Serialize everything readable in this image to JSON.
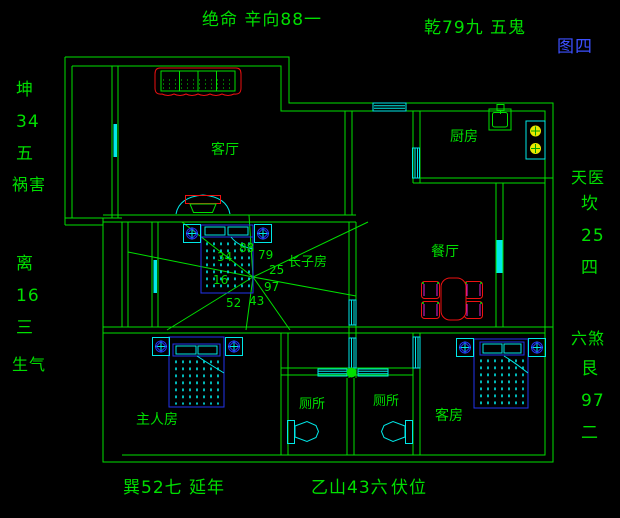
{
  "figure_label": "图四",
  "perimeter": {
    "top": [
      "绝命 辛向88一",
      "乾79九 五鬼"
    ],
    "left": [
      "坤",
      "34",
      "五",
      "祸害",
      "离",
      "16",
      "三",
      "生气"
    ],
    "right": [
      "天医",
      "坎",
      "25",
      "四",
      "六煞",
      "艮",
      "97",
      "二"
    ],
    "bottom": [
      "巽52七",
      "延年",
      "乙山43六",
      "伏位"
    ]
  },
  "rooms": {
    "living_room": "客厅",
    "kitchen": "厨房",
    "dining_room": "餐厅",
    "eldest_son_room": "长子房",
    "master_bedroom": "主人房",
    "toilet_left": "厕所",
    "toilet_right": "厕所",
    "guest_room": "客房"
  },
  "compass_numbers": [
    "88",
    "79",
    "25",
    "97",
    "43",
    "52",
    "16",
    "34"
  ],
  "colors": {
    "background": "#000000",
    "wall_green": "#00df00",
    "cyan": "#00e8e8",
    "furniture_blue": "#2233ee",
    "red": "#ee1111",
    "magenta": "#dd22dd",
    "burner_yellow": "#e8e800",
    "figure_label_blue": "#3c50ff"
  }
}
